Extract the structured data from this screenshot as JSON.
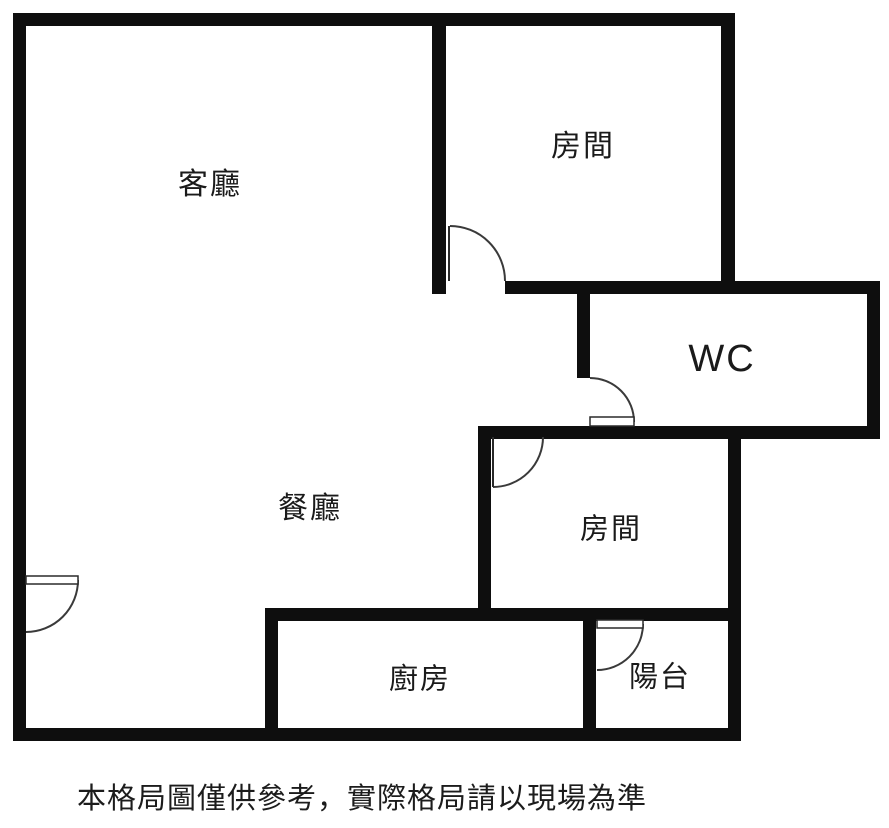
{
  "floorplan": {
    "canvas": {
      "width": 889,
      "height": 828,
      "background": "#ffffff",
      "wall_color": "#0e0e0e",
      "door_stroke": "#3a3a3a"
    },
    "rooms": [
      {
        "name": "living-room",
        "label": "客廳",
        "x": 210,
        "y": 185,
        "font_size": 30
      },
      {
        "name": "bedroom-top",
        "label": "房間",
        "x": 583,
        "y": 147,
        "font_size": 30
      },
      {
        "name": "wc",
        "label": "WC",
        "x": 722,
        "y": 359,
        "font_size": 38
      },
      {
        "name": "dining-room",
        "label": "餐廳",
        "x": 310,
        "y": 509,
        "font_size": 30
      },
      {
        "name": "bedroom-middle",
        "label": "房間",
        "x": 611,
        "y": 530,
        "font_size": 29
      },
      {
        "name": "kitchen",
        "label": "廚房",
        "x": 420,
        "y": 680,
        "font_size": 29
      },
      {
        "name": "balcony",
        "label": "陽台",
        "x": 660,
        "y": 678,
        "font_size": 29
      }
    ],
    "walls": [
      {
        "name": "outer-left-wall",
        "x": 13,
        "y": 13,
        "w": 13,
        "h": 728
      },
      {
        "name": "outer-top-wall",
        "x": 13,
        "y": 13,
        "w": 722,
        "h": 13
      },
      {
        "name": "outer-bottom-wall",
        "x": 13,
        "y": 728,
        "w": 728,
        "h": 13
      },
      {
        "name": "bedroom-top-left-wall",
        "x": 432,
        "y": 13,
        "w": 14,
        "h": 281
      },
      {
        "name": "bedroom-top-right-wall",
        "x": 721,
        "y": 13,
        "w": 14,
        "h": 281
      },
      {
        "name": "bedroom-bottom-wc-top-wall",
        "x": 505,
        "y": 281,
        "w": 375,
        "h": 13
      },
      {
        "name": "wc-left-wall",
        "x": 577,
        "y": 281,
        "w": 13,
        "h": 97
      },
      {
        "name": "outer-right-wc-wall",
        "x": 867,
        "y": 281,
        "w": 13,
        "h": 158
      },
      {
        "name": "wc-bottom-bedroom-middle-top-wall",
        "x": 478,
        "y": 426,
        "w": 402,
        "h": 13
      },
      {
        "name": "bedroom-middle-left-wall",
        "x": 478,
        "y": 426,
        "w": 13,
        "h": 194
      },
      {
        "name": "bedroom-middle-balcony-right-wall",
        "x": 728,
        "y": 426,
        "w": 13,
        "h": 315
      },
      {
        "name": "kitchen-top-bedroom-middle-bottom-wall",
        "x": 265,
        "y": 608,
        "w": 476,
        "h": 13
      },
      {
        "name": "kitchen-left-wall",
        "x": 265,
        "y": 608,
        "w": 13,
        "h": 133
      },
      {
        "name": "balcony-left-wall",
        "x": 583,
        "y": 608,
        "w": 13,
        "h": 133
      }
    ],
    "doors": [
      {
        "name": "bedroom-top-door",
        "arc": "M450,226 A55,55 0 0 1 505,281",
        "panel_line": "M449,226 L449,281"
      },
      {
        "name": "wc-door",
        "arc": "M590,378 A44,44 0 0 1 634,422",
        "panel_rect": {
          "x": 590,
          "y": 417,
          "w": 44,
          "h": 9
        }
      },
      {
        "name": "bedroom-middle-door",
        "arc": "M543,437 A50,50 0 0 1 493,487",
        "panel_line": "M493,437 L493,487"
      },
      {
        "name": "balcony-door",
        "arc": "M643,624 A46,46 0 0 1 597,670",
        "panel_rect": {
          "x": 597,
          "y": 620,
          "w": 46,
          "h": 8
        }
      },
      {
        "name": "entrance-door",
        "arc": "M78,580 A52,52 0 0 1 26,632",
        "panel_rect": {
          "x": 26,
          "y": 576,
          "w": 52,
          "h": 8
        }
      }
    ],
    "disclaimer": {
      "text": "本格局圖僅供參考，實際格局請以現場為準",
      "x": 77,
      "y": 784,
      "font_size": 29
    }
  }
}
